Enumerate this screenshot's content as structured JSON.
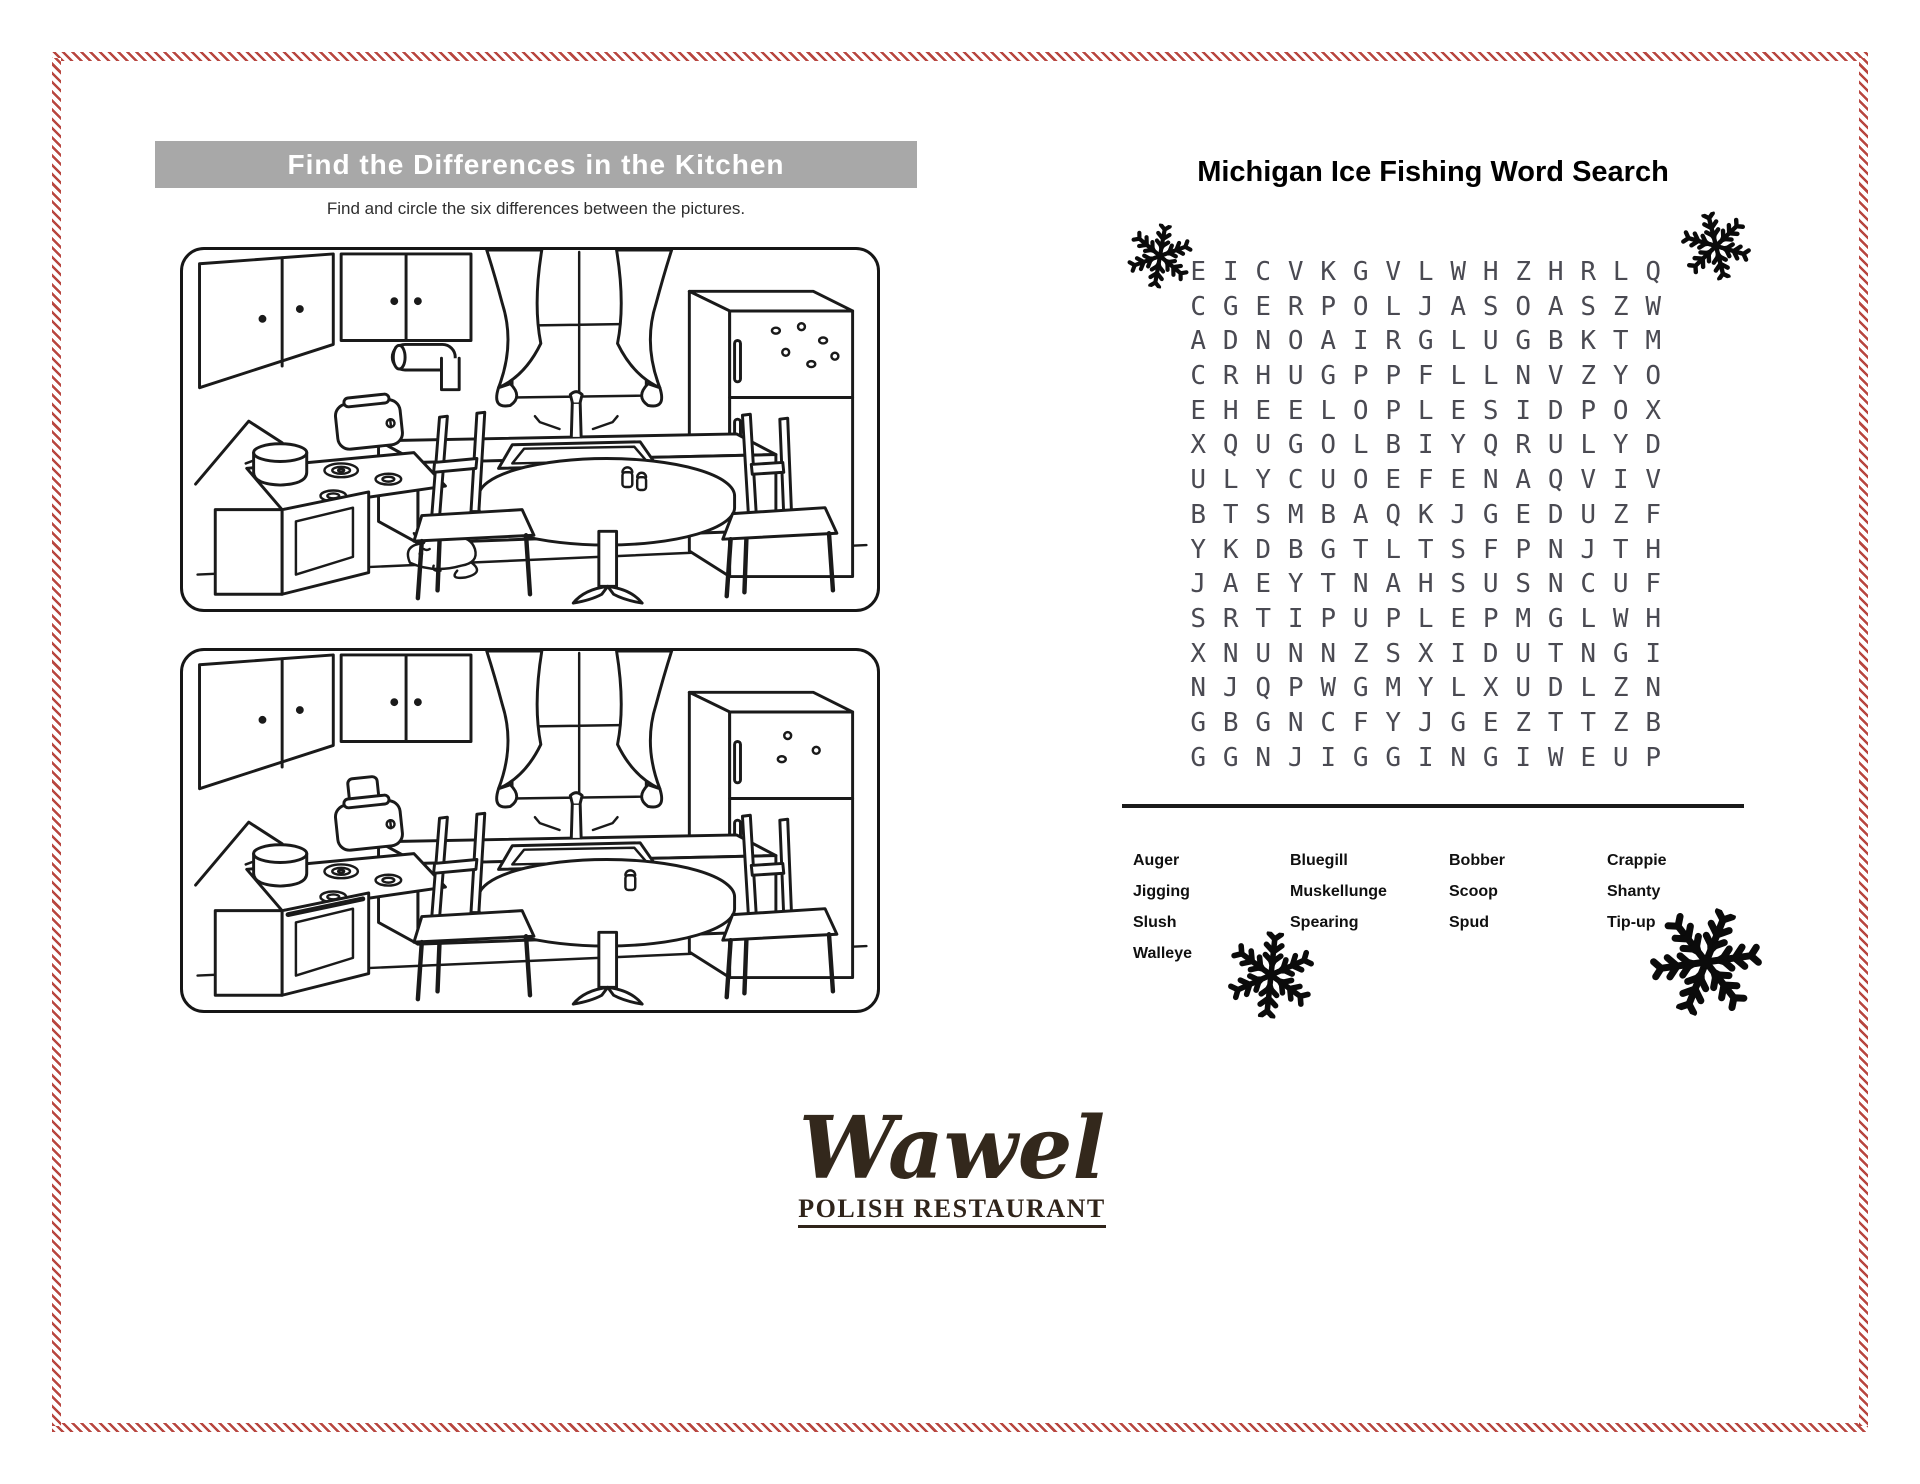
{
  "page": {
    "background": "#ffffff",
    "frame_stripe_color": "#b8463f"
  },
  "find_differences": {
    "banner_title": "Find the Differences in the Kitchen",
    "banner_bg": "#a8a8a8",
    "instructions": "Find and circle the six differences between the pictures.",
    "scene_elements": [
      "wall-cabinets",
      "window-with-curtains",
      "paper-towel-roll",
      "refrigerator-with-magnets",
      "sink-with-faucet",
      "toaster",
      "stove-with-pot",
      "sleeping-cat",
      "round-pedestal-table",
      "salt-pepper-shakers",
      "chairs"
    ]
  },
  "word_search": {
    "title": "Michigan Ice Fishing Word Search",
    "grid_rows": [
      "EICVKGVLWHZHRLQ",
      "CGERPOLJASOASZW",
      "ADNOAIRGLUGBKTM",
      "CRHUGPPFLLNVZYO",
      "EHEELOPLESIDPOX",
      "XQUGOLBIYQRULYD",
      "ULYCUOEFENAQVIV",
      "BTSMBAQKJGEDUZF",
      "YKDBGTLTSFPNJTH",
      "JAEYTNAHSUSNCUF",
      "SRTIPUPLEPMGLWH",
      "XNUNNZSXIDUTNGI",
      "NJQPWGMYLXUDLZN",
      "GBGNCFYJGEZTTZB",
      "GGNJIGGINGIWEUP"
    ],
    "word_columns": [
      [
        "Auger",
        "Jigging",
        "Slush",
        "Walleye"
      ],
      [
        "Bluegill",
        "Muskellunge",
        "Spearing"
      ],
      [
        "Bobber",
        "Scoop",
        "Spud"
      ],
      [
        "Crappie",
        "Shanty",
        "Tip-up"
      ]
    ],
    "letter_color": "#4a4a52"
  },
  "logo": {
    "script_name": "Wawel",
    "subtitle": "POLISH RESTAURANT",
    "color": "#33281c"
  }
}
